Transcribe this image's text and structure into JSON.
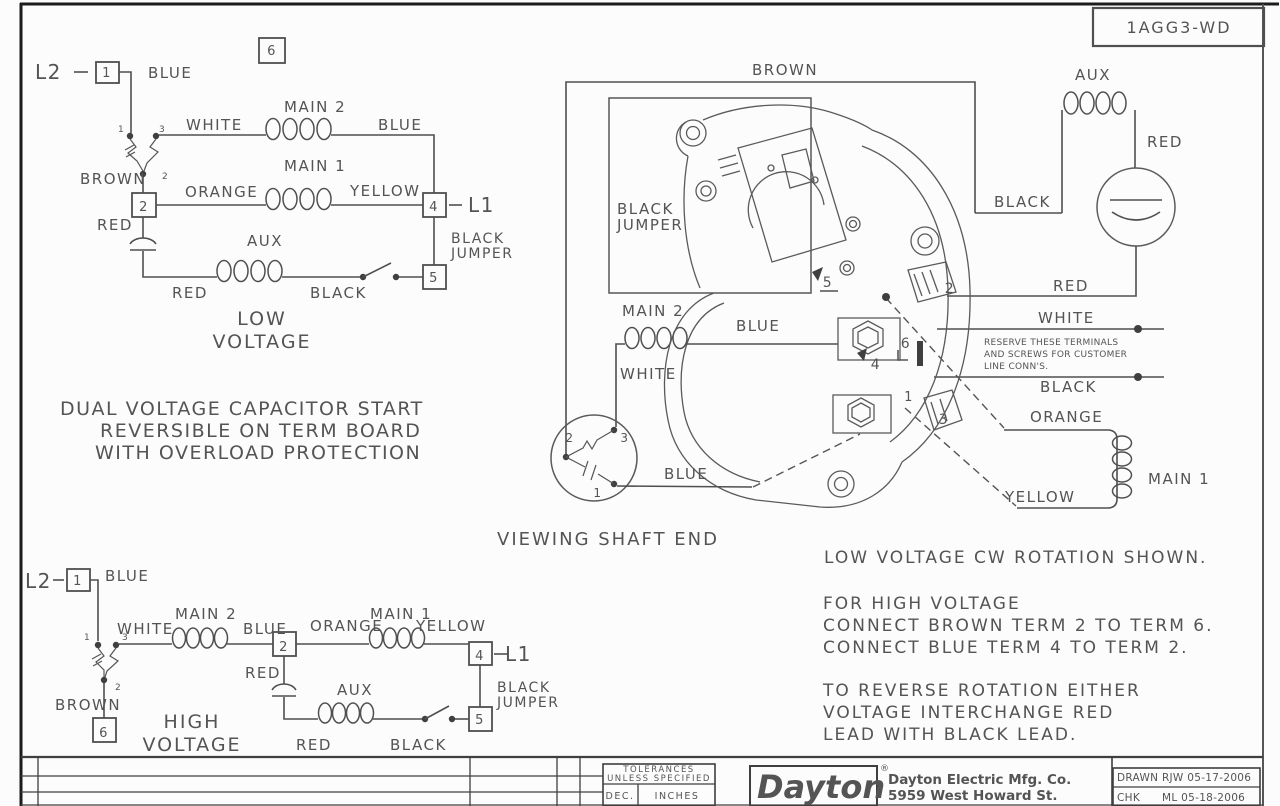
{
  "page": {
    "bg": "#fcfcfc",
    "line_color": "#4f4f4f",
    "text_color": "#545454",
    "logo_color": "#111111"
  },
  "drawing_number": "1AGG3-WD",
  "title_block": {
    "tolerances_line1": "TOLERANCES",
    "tolerances_line2": "UNLESS SPECIFIED",
    "dec": "DEC.",
    "inches": "INCHES",
    "logo": "Dayton",
    "registered": "®",
    "company_line1": "Dayton Electric Mfg. Co.",
    "company_line2": "5959 West Howard St.",
    "drawn": "DRAWN RJW 05-17-2006",
    "chk": "CHK",
    "chk_value": "ML 05-18-2006"
  },
  "labels": [
    {
      "name": "lv-l2",
      "text": "L2",
      "x": 35,
      "y": 79,
      "size": 20
    },
    {
      "name": "lv-terminal-1",
      "text": "1",
      "x": 107,
      "y": 77,
      "size": 13,
      "anchor": "middle"
    },
    {
      "name": "lv-blue-top",
      "text": "BLUE",
      "x": 148,
      "y": 78,
      "size": 15
    },
    {
      "name": "lv-terminal-6-label",
      "text": "6",
      "x": 272,
      "y": 55,
      "size": 13,
      "anchor": "middle"
    },
    {
      "name": "lv-contact-1",
      "text": "1",
      "x": 118,
      "y": 132,
      "size": 9
    },
    {
      "name": "lv-contact-3",
      "text": "3",
      "x": 159,
      "y": 132,
      "size": 9
    },
    {
      "name": "lv-white",
      "text": "WHITE",
      "x": 186,
      "y": 130,
      "size": 15
    },
    {
      "name": "lv-main2",
      "text": "MAIN 2",
      "x": 284,
      "y": 112,
      "size": 15
    },
    {
      "name": "lv-blue-mid",
      "text": "BLUE",
      "x": 378,
      "y": 130,
      "size": 15
    },
    {
      "name": "lv-contact-2",
      "text": "2",
      "x": 162,
      "y": 179,
      "size": 9
    },
    {
      "name": "lv-brown",
      "text": "BROWN",
      "x": 80,
      "y": 184,
      "size": 15
    },
    {
      "name": "lv-terminal-2",
      "text": "2",
      "x": 144,
      "y": 211,
      "size": 13,
      "anchor": "middle"
    },
    {
      "name": "lv-orange",
      "text": "ORANGE",
      "x": 185,
      "y": 197,
      "size": 15
    },
    {
      "name": "lv-main1",
      "text": "MAIN 1",
      "x": 284,
      "y": 171,
      "size": 15
    },
    {
      "name": "lv-yellow",
      "text": "YELLOW",
      "x": 350,
      "y": 196,
      "size": 15
    },
    {
      "name": "lv-terminal-4",
      "text": "4",
      "x": 434,
      "y": 211,
      "size": 13,
      "anchor": "middle"
    },
    {
      "name": "lv-l1",
      "text": "L1",
      "x": 468,
      "y": 212,
      "size": 20
    },
    {
      "name": "lv-red-cap",
      "text": "RED",
      "x": 97,
      "y": 230,
      "size": 15
    },
    {
      "name": "lv-aux",
      "text": "AUX",
      "x": 247,
      "y": 246,
      "size": 15
    },
    {
      "name": "lv-black-jumper-1",
      "text": "BLACK",
      "x": 451,
      "y": 243,
      "size": 14
    },
    {
      "name": "lv-black-jumper-2",
      "text": "JUMPER",
      "x": 451,
      "y": 258,
      "size": 14
    },
    {
      "name": "lv-terminal-5",
      "text": "5",
      "x": 434,
      "y": 282,
      "size": 13,
      "anchor": "middle"
    },
    {
      "name": "lv-red-bottom",
      "text": "RED",
      "x": 172,
      "y": 298,
      "size": 15
    },
    {
      "name": "lv-black-bottom",
      "text": "BLACK",
      "x": 310,
      "y": 298,
      "size": 15
    },
    {
      "name": "caption-low-1",
      "text": "LOW",
      "x": 262,
      "y": 325,
      "size": 19,
      "anchor": "middle",
      "ls": 2
    },
    {
      "name": "caption-low-2",
      "text": "VOLTAGE",
      "x": 262,
      "y": 348,
      "size": 19,
      "anchor": "middle",
      "ls": 2
    },
    {
      "name": "description-1",
      "text": "DUAL VOLTAGE CAPACITOR START",
      "x": 60,
      "y": 415,
      "size": 19,
      "ls": 1.5
    },
    {
      "name": "description-2",
      "text": "REVERSIBLE ON TERM BOARD",
      "x": 100,
      "y": 437,
      "size": 19,
      "ls": 1.5
    },
    {
      "name": "description-3",
      "text": "WITH OVERLOAD PROTECTION",
      "x": 95,
      "y": 459,
      "size": 19,
      "ls": 1.5
    },
    {
      "name": "motor-brown",
      "text": "BROWN",
      "x": 752,
      "y": 75,
      "size": 15
    },
    {
      "name": "motor-black-jumper-1",
      "text": "BLACK",
      "x": 617,
      "y": 214,
      "size": 15
    },
    {
      "name": "motor-black-jumper-2",
      "text": "JUMPER",
      "x": 617,
      "y": 230,
      "size": 15
    },
    {
      "name": "motor-aux",
      "text": "AUX",
      "x": 1075,
      "y": 80,
      "size": 15
    },
    {
      "name": "motor-red-right",
      "text": "RED",
      "x": 1147,
      "y": 147,
      "size": 15
    },
    {
      "name": "motor-black-aux",
      "text": "BLACK",
      "x": 994,
      "y": 207,
      "size": 15
    },
    {
      "name": "motor-red-wire",
      "text": "RED",
      "x": 1053,
      "y": 291,
      "size": 15
    },
    {
      "name": "motor-main2",
      "text": "MAIN 2",
      "x": 622,
      "y": 316,
      "size": 15
    },
    {
      "name": "motor-blue-top",
      "text": "BLUE",
      "x": 736,
      "y": 331,
      "size": 15
    },
    {
      "name": "motor-white",
      "text": "WHITE",
      "x": 620,
      "y": 379,
      "size": 15
    },
    {
      "name": "switch-contact-2",
      "text": "2",
      "x": 570,
      "y": 442,
      "size": 12,
      "anchor": "middle"
    },
    {
      "name": "switch-contact-3",
      "text": "3",
      "x": 625,
      "y": 442,
      "size": 12,
      "anchor": "middle"
    },
    {
      "name": "switch-contact-1",
      "text": "1",
      "x": 598,
      "y": 497,
      "size": 12,
      "anchor": "middle"
    },
    {
      "name": "motor-blue-bottom",
      "text": "BLUE",
      "x": 664,
      "y": 479,
      "size": 15
    },
    {
      "name": "motor-white-line",
      "text": "WHITE",
      "x": 1038,
      "y": 323,
      "size": 15
    },
    {
      "name": "reserve-note-1",
      "text": "RESERVE THESE TERMINALS",
      "x": 984,
      "y": 345,
      "size": 9,
      "ls": 0.3
    },
    {
      "name": "reserve-note-2",
      "text": "AND SCREWS FOR CUSTOMER",
      "x": 984,
      "y": 357,
      "size": 9,
      "ls": 0.3
    },
    {
      "name": "reserve-note-3",
      "text": "LINE CONN'S.",
      "x": 984,
      "y": 369,
      "size": 9,
      "ls": 0.3
    },
    {
      "name": "motor-black-line",
      "text": "BLACK",
      "x": 1040,
      "y": 392,
      "size": 15
    },
    {
      "name": "motor-orange",
      "text": "ORANGE",
      "x": 1030,
      "y": 422,
      "size": 15
    },
    {
      "name": "motor-main1",
      "text": "MAIN 1",
      "x": 1148,
      "y": 484,
      "size": 15
    },
    {
      "name": "motor-yellow",
      "text": "YELLOW",
      "x": 1005,
      "y": 502,
      "size": 15
    },
    {
      "name": "motor-terminal-5",
      "text": "5",
      "x": 828,
      "y": 287,
      "size": 14,
      "anchor": "middle"
    },
    {
      "name": "motor-terminal-2",
      "text": "2",
      "x": 950,
      "y": 293,
      "size": 14,
      "anchor": "middle"
    },
    {
      "name": "motor-terminal-6",
      "text": "6",
      "x": 906,
      "y": 348,
      "size": 14,
      "anchor": "middle"
    },
    {
      "name": "motor-terminal-4",
      "text": "4",
      "x": 876,
      "y": 369,
      "size": 14,
      "anchor": "middle"
    },
    {
      "name": "motor-terminal-1",
      "text": "1",
      "x": 909,
      "y": 401,
      "size": 13,
      "anchor": "middle"
    },
    {
      "name": "motor-terminal-3",
      "text": "3",
      "x": 944,
      "y": 424,
      "size": 14,
      "anchor": "middle"
    },
    {
      "name": "viewing-shaft-end",
      "text": "VIEWING SHAFT END",
      "x": 608,
      "y": 545,
      "size": 18,
      "anchor": "middle",
      "ls": 2
    },
    {
      "name": "note-rotation",
      "text": "LOW VOLTAGE CW ROTATION SHOWN.",
      "x": 824,
      "y": 563,
      "size": 17,
      "ls": 2
    },
    {
      "name": "note-hv-1",
      "text": "FOR HIGH VOLTAGE",
      "x": 823,
      "y": 609,
      "size": 17,
      "ls": 2
    },
    {
      "name": "note-hv-2",
      "text": "CONNECT BROWN TERM 2 TO TERM 6.",
      "x": 823,
      "y": 631,
      "size": 17,
      "ls": 2
    },
    {
      "name": "note-hv-3",
      "text": "CONNECT BLUE TERM 4 TO TERM 2.",
      "x": 823,
      "y": 653,
      "size": 17,
      "ls": 2
    },
    {
      "name": "note-reverse-1",
      "text": "TO REVERSE ROTATION EITHER",
      "x": 823,
      "y": 696,
      "size": 17,
      "ls": 2
    },
    {
      "name": "note-reverse-2",
      "text": "VOLTAGE INTERCHANGE RED",
      "x": 823,
      "y": 718,
      "size": 17,
      "ls": 2
    },
    {
      "name": "note-reverse-3",
      "text": "LEAD WITH BLACK LEAD.",
      "x": 823,
      "y": 740,
      "size": 17,
      "ls": 2
    },
    {
      "name": "hv-l2",
      "text": "L2",
      "x": 25,
      "y": 588,
      "size": 20
    },
    {
      "name": "hv-terminal-1",
      "text": "1",
      "x": 78,
      "y": 585,
      "size": 13,
      "anchor": "middle"
    },
    {
      "name": "hv-blue-top",
      "text": "BLUE",
      "x": 105,
      "y": 581,
      "size": 15
    },
    {
      "name": "hv-contact-1",
      "text": "1",
      "x": 84,
      "y": 640,
      "size": 9
    },
    {
      "name": "hv-contact-3",
      "text": "3",
      "x": 122,
      "y": 640,
      "size": 9
    },
    {
      "name": "hv-white",
      "text": "WHITE",
      "x": 117,
      "y": 634,
      "size": 15
    },
    {
      "name": "hv-main2",
      "text": "MAIN 2",
      "x": 175,
      "y": 619,
      "size": 15
    },
    {
      "name": "hv-blue-mid",
      "text": "BLUE",
      "x": 243,
      "y": 634,
      "size": 15
    },
    {
      "name": "hv-terminal-2",
      "text": "2",
      "x": 284,
      "y": 651,
      "size": 13,
      "anchor": "middle"
    },
    {
      "name": "hv-orange",
      "text": "ORANGE",
      "x": 310,
      "y": 631,
      "size": 15
    },
    {
      "name": "hv-main1",
      "text": "MAIN 1",
      "x": 370,
      "y": 619,
      "size": 15
    },
    {
      "name": "hv-yellow",
      "text": "YELLOW",
      "x": 416,
      "y": 631,
      "size": 15
    },
    {
      "name": "hv-terminal-4",
      "text": "4",
      "x": 480,
      "y": 660,
      "size": 13,
      "anchor": "middle"
    },
    {
      "name": "hv-l1",
      "text": "L1",
      "x": 505,
      "y": 661,
      "size": 20
    },
    {
      "name": "hv-contact-2",
      "text": "2",
      "x": 115,
      "y": 690,
      "size": 9
    },
    {
      "name": "hv-brown",
      "text": "BROWN",
      "x": 55,
      "y": 710,
      "size": 15
    },
    {
      "name": "hv-terminal-6",
      "text": "6",
      "x": 104,
      "y": 737,
      "size": 13,
      "anchor": "middle"
    },
    {
      "name": "caption-high-1",
      "text": "HIGH",
      "x": 192,
      "y": 728,
      "size": 19,
      "anchor": "middle",
      "ls": 2
    },
    {
      "name": "caption-high-2",
      "text": "VOLTAGE",
      "x": 192,
      "y": 751,
      "size": 19,
      "anchor": "middle",
      "ls": 2
    },
    {
      "name": "hv-red-cap",
      "text": "RED",
      "x": 245,
      "y": 678,
      "size": 15
    },
    {
      "name": "hv-aux",
      "text": "AUX",
      "x": 337,
      "y": 695,
      "size": 15
    },
    {
      "name": "hv-red-bottom",
      "text": "RED",
      "x": 296,
      "y": 750,
      "size": 15
    },
    {
      "name": "hv-black-bottom",
      "text": "BLACK",
      "x": 390,
      "y": 750,
      "size": 15
    },
    {
      "name": "hv-black-jumper-1",
      "text": "BLACK",
      "x": 497,
      "y": 692,
      "size": 14
    },
    {
      "name": "hv-black-jumper-2",
      "text": "JUMPER",
      "x": 497,
      "y": 707,
      "size": 14
    },
    {
      "name": "hv-terminal-5",
      "text": "5",
      "x": 480,
      "y": 724,
      "size": 13,
      "anchor": "middle"
    },
    {
      "name": "drawing-number-label",
      "text": "1AGG3-WD",
      "x": 1179,
      "y": 33,
      "size": 16,
      "anchor": "middle",
      "ls": 2
    },
    {
      "name": "tb-tolerances-1",
      "text": "TOLERANCES",
      "x": 659,
      "y": 772,
      "size": 8.5,
      "anchor": "middle"
    },
    {
      "name": "tb-tolerances-2",
      "text": "UNLESS SPECIFIED",
      "x": 659,
      "y": 781,
      "size": 8.5,
      "anchor": "middle"
    },
    {
      "name": "tb-dec",
      "text": "DEC.",
      "x": 620,
      "y": 799,
      "size": 9.5,
      "anchor": "middle"
    },
    {
      "name": "tb-inches",
      "text": "INCHES",
      "x": 677,
      "y": 799,
      "size": 9.5,
      "anchor": "middle"
    },
    {
      "name": "tb-logo",
      "text": "Dayton",
      "x": 757,
      "y": 798,
      "size": 32,
      "bold": true,
      "italic": true,
      "color": "#111111",
      "ls": 0
    },
    {
      "name": "tb-registered",
      "text": "®",
      "x": 880,
      "y": 771,
      "size": 9,
      "color": "#111111",
      "ls": 0
    },
    {
      "name": "tb-company-1",
      "text": "Dayton Electric Mfg. Co.",
      "x": 888,
      "y": 784,
      "size": 13.5,
      "bold": true,
      "color": "#1e1e1e",
      "ls": 0
    },
    {
      "name": "tb-company-2",
      "text": "5959 West Howard St.",
      "x": 888,
      "y": 800,
      "size": 13.5,
      "bold": true,
      "color": "#1e1e1e",
      "ls": 0
    },
    {
      "name": "tb-drawn",
      "text": "DRAWN RJW 05-17-2006",
      "x": 1117,
      "y": 781,
      "size": 10.5,
      "ls": 0.3
    },
    {
      "name": "tb-chk",
      "text": "CHK",
      "x": 1117,
      "y": 801,
      "size": 10.5,
      "ls": 0.3
    },
    {
      "name": "tb-chk-value",
      "text": "ML 05-18-2006",
      "x": 1162,
      "y": 801,
      "size": 10.5,
      "ls": 0.3
    }
  ]
}
